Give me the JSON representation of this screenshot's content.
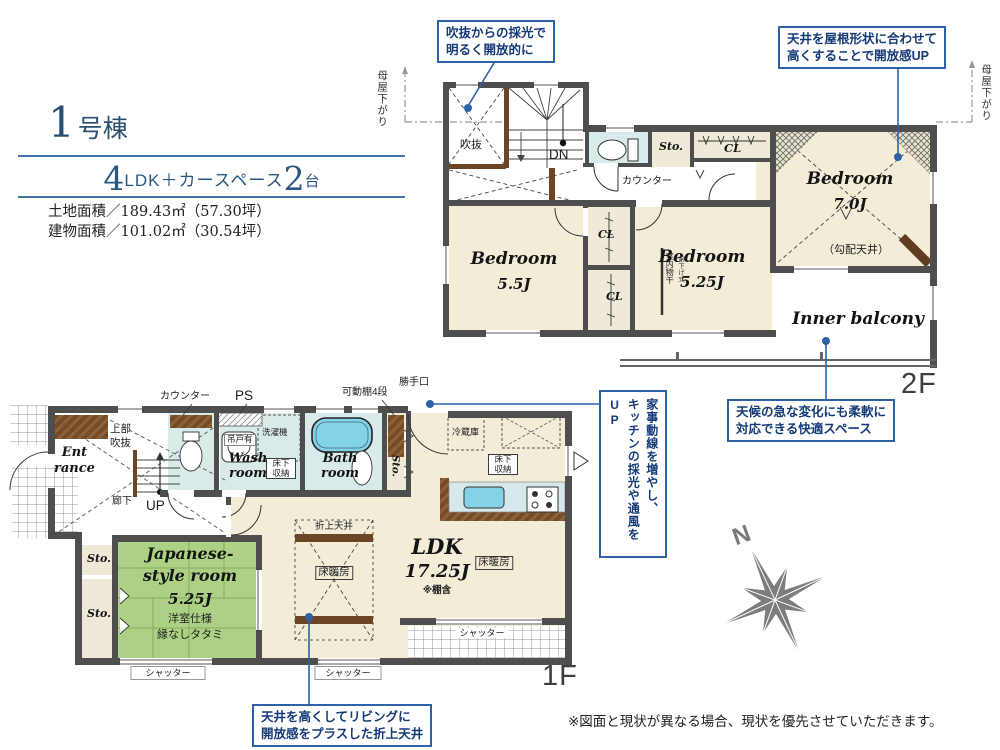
{
  "header": {
    "unit_number": "1",
    "unit_label": "号棟",
    "plan_num_rooms": "4",
    "plan_type": "LDK＋カースペース",
    "plan_cars": "2",
    "plan_cars_unit": "台",
    "land_area": "土地面積／189.43㎡（57.30坪）",
    "building_area": "建物面積／101.02㎡（30.54坪）"
  },
  "callouts": {
    "void_light": {
      "line1": "吹抜からの採光で",
      "line2": "明るく開放的に"
    },
    "sloped_ceiling": {
      "line1": "天井を屋根形状に合わせて",
      "line2": "高くすることで開放感UP"
    },
    "inner_balcony": {
      "line1": "天候の急な変化にも柔軟に",
      "line2": "対応できる快適スペース"
    },
    "kitchen_flow": {
      "line1": "家事動線を増やし、",
      "line2": "キッチンの採光や通風をUP"
    },
    "coffered_ceiling": {
      "line1": "天井を高くしてリビングに",
      "line2": "開放感をプラスした折上天井"
    }
  },
  "floor2": {
    "tag": "2F",
    "moya_sagari_left": "母屋下がり",
    "moya_sagari_right": "母屋下がり",
    "void": "吹抜",
    "down": "DN",
    "counter": "カウンター",
    "storage": "Sto.",
    "closet_top": "CL",
    "closet_upper": "CL",
    "closet_lower": "CL",
    "bedroom1": {
      "name": "Bedroom",
      "size": "5.5J"
    },
    "bedroom2": {
      "name": "Bedroom",
      "size": "5.25J"
    },
    "bedroom3": {
      "name": "Bedroom",
      "size": "7.0J",
      "note": "（勾配天井）"
    },
    "laundry_pole": "室内物干",
    "laundry_pole_type": "吊下げ式",
    "inner_balcony": "Inner balcony"
  },
  "floor1": {
    "tag": "1F",
    "counter": "カウンター",
    "pipe_space": "PS",
    "hanging_cupboard": "吊戸有",
    "washer": "洗濯機",
    "wash_room": "Wash room",
    "underfloor_storage_wash": "床下収納",
    "underfloor_storage_kitchen": "床下収納",
    "bath_room": "Bath room",
    "storage_pantry": "Sto.",
    "storage_upper": "Sto.",
    "storage_lower": "Sto.",
    "movable_shelf": "可動棚4段",
    "back_door": "勝手口",
    "fridge": "冷蔵庫",
    "ldk": {
      "name": "LDK",
      "size": "17.25J",
      "note": "※棚含"
    },
    "floor_heating_left": "床暖房",
    "floor_heating_right": "床暖房",
    "coffered": "折上天井",
    "entrance": {
      "line1": "Ent",
      "line2": "rance"
    },
    "upper_void": {
      "line1": "上部",
      "line2": "吹抜"
    },
    "hallway": "廊下",
    "up": "UP",
    "japanese_room": {
      "line1": "Japanese-",
      "line2": "style room",
      "size": "5.25J",
      "note1": "洋室仕様",
      "note2": "縁なしタタミ"
    },
    "shutter_left": "シャッター",
    "shutter_center": "シャッター",
    "shutter_right": "シャッター"
  },
  "compass": {
    "north_label": "N"
  },
  "footer": {
    "disclaimer": "※図面と現状が異なる場合、現状を優先させていただきます。"
  },
  "colors": {
    "accent_blue": "#2d62a8",
    "navy_text": "#143a78",
    "wall": "#4e4e4e",
    "room_beige": "#f3edd8",
    "wet_blue": "#d9eaeb",
    "tatami_green": "#acd185",
    "tub_blue": "#84d2e6",
    "wood_brown": "#754e2a"
  }
}
